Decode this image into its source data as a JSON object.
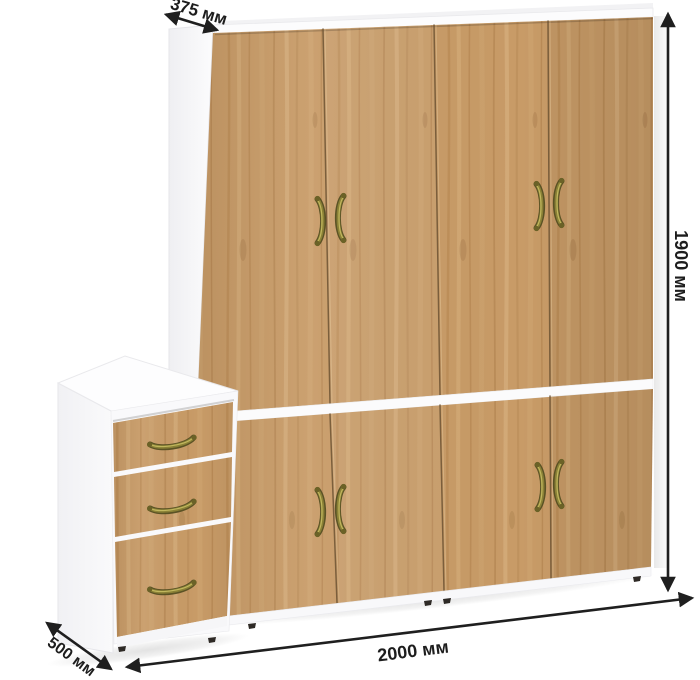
{
  "image": {
    "description": "Product render of a white and oak wardrobe with a three-drawer side cabinet, annotated with dimension arrows",
    "background_color": "#ffffff"
  },
  "dimensions": {
    "top_depth": {
      "label": "375 мм"
    },
    "height": {
      "label": "1900 мм"
    },
    "width": {
      "label": "2000 мм"
    },
    "cabinet_depth": {
      "label": "500 мм"
    }
  },
  "furniture": {
    "wardrobe": {
      "upper_door_count": 4,
      "lower_door_count": 4,
      "carcass_color": "#ffffff",
      "wood_color": "#c89b67",
      "handle_color": "#8a8136"
    },
    "drawer_cabinet": {
      "drawer_count": 3,
      "carcass_color": "#ffffff",
      "wood_color": "#c89b67"
    }
  },
  "annotation_style": {
    "arrow_color": "#1f1f1f",
    "text_color": "#1d1d1d"
  }
}
